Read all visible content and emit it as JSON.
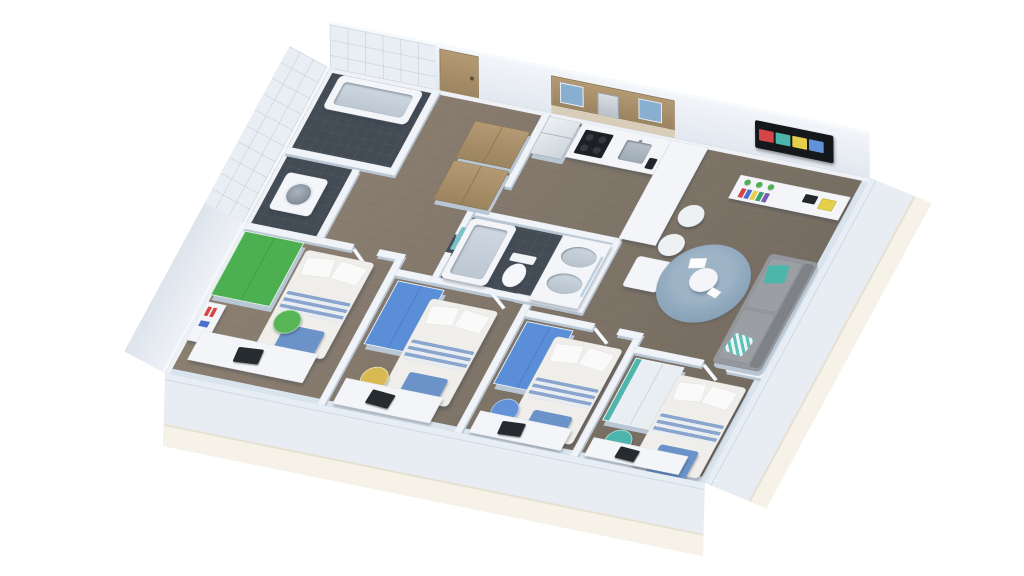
{
  "scene": {
    "type": "3d-floorplan-render",
    "subject": "isometric 3D floor plan of a four-bedroom apartment with open kitchen and living area",
    "background": "#ffffff"
  },
  "palette": {
    "floor_wood": "#8d8173",
    "floor_wood_dark": "#746b60",
    "tile_dark": "#434b54",
    "wall": "#f0f4f8",
    "wall_edge": "#d9e4ee",
    "wall_shadow": "#b9c6d4",
    "glass": "#aecde5",
    "plinth": "#f6f2e8",
    "cabinet_wood": "#b49a73",
    "cabinet_wood_dark": "#9c8460",
    "appliance_dark": "#1d2125",
    "steel": "#c6ced6",
    "bed_linen": "#efeeea",
    "bed_stripe": "#8aa6cf",
    "bed_throw": "#6b93c9",
    "pillow": "#fafafa",
    "green": "#4cb050",
    "chair_yellow": "#d9b952",
    "chair_blue": "#6292d8",
    "chair_teal": "#4db6ac",
    "chair_green": "#58b556",
    "wardrobe_blue": "#5a8fd8",
    "sofa": "#94979b",
    "sofa_dark": "#7e8287",
    "rug": "#8aa3b8",
    "tv_black": "#15181b",
    "towel_teal": "#79c2c8",
    "laptop": "#262b30",
    "book_red": "#d64545"
  },
  "windows": {
    "front_panels": 8,
    "side_panels": 4
  },
  "console_books": [
    "#d64545",
    "#4a6fd0",
    "#e3cf4a",
    "#3aa06a",
    "#7a5ab0"
  ],
  "tv_tiles": [
    "#d64545",
    "#4db6ac",
    "#e3cf4a",
    "#6292d8"
  ],
  "rooms": [
    {
      "id": "bathroom-main",
      "name": "bathroom with bathtub",
      "furniture": [
        "bathtub"
      ]
    },
    {
      "id": "laundry",
      "name": "laundry room",
      "furniture": [
        "washing-machine"
      ]
    },
    {
      "id": "entry-hall",
      "name": "entry hall",
      "furniture": [
        "closet",
        "closet",
        "entry-door"
      ]
    },
    {
      "id": "kitchen",
      "name": "open kitchen",
      "furniture": [
        "fridge",
        "stove",
        "sink",
        "upper-cabinets",
        "peninsula-counter",
        "dining-table",
        "bar-stool",
        "bar-stool"
      ]
    },
    {
      "id": "living-room",
      "name": "living room",
      "furniture": [
        "wall-tv",
        "media-console",
        "sofa",
        "round-rug",
        "coffee-table",
        "papers"
      ]
    },
    {
      "id": "bathroom-shared",
      "name": "shared bathroom",
      "furniture": [
        "bathtub",
        "toilet",
        "double-vanity",
        "towel"
      ]
    },
    {
      "id": "bedroom-1",
      "name": "bedroom 1",
      "furniture": [
        "green-wardrobe",
        "bed",
        "bookshelf",
        "green-chair",
        "desk",
        "laptop"
      ]
    },
    {
      "id": "bedroom-2",
      "name": "bedroom 2",
      "furniture": [
        "blue-wardrobe",
        "bed",
        "yellow-chair",
        "desk",
        "laptop"
      ]
    },
    {
      "id": "bedroom-3",
      "name": "bedroom 3",
      "furniture": [
        "blue-wardrobe",
        "bed",
        "blue-chair",
        "desk",
        "laptop"
      ]
    },
    {
      "id": "bedroom-4",
      "name": "bedroom 4",
      "furniture": [
        "wardrobe",
        "bed",
        "teal-chair",
        "desk",
        "laptop"
      ]
    }
  ]
}
